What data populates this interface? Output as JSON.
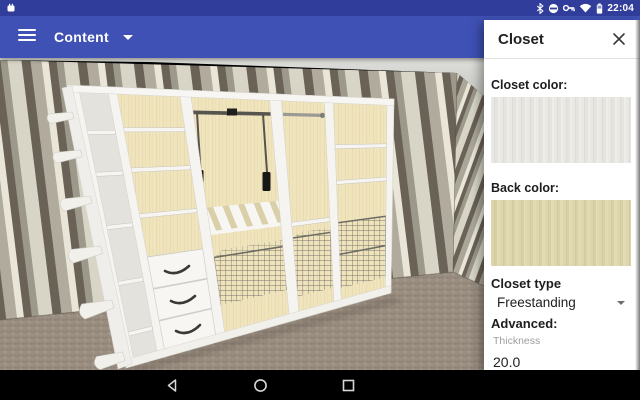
{
  "status_bar": {
    "time": "22:04",
    "left_icon": "app-notification-icon",
    "right_icons": [
      "bluetooth-icon",
      "do-not-disturb-icon",
      "key-icon",
      "wifi-icon",
      "battery-icon"
    ]
  },
  "toolbar": {
    "title": "Content",
    "menu_icon": "hamburger-menu-icon",
    "caret_icon": "dropdown-caret-icon"
  },
  "panel": {
    "title": "Closet",
    "close_icon": "close-icon",
    "closet_color_label": "Closet color:",
    "closet_color_swatch": "#e7e6e1",
    "back_color_label": "Back color:",
    "back_color_swatch": "#ddd5ab",
    "closet_type_label": "Closet type",
    "closet_type_value": "Freestanding",
    "advanced_label": "Advanced:",
    "thickness_label": "Thickness",
    "thickness_value": "20.0"
  },
  "navbar": {
    "icons": [
      "back-icon",
      "home-icon",
      "recents-icon"
    ]
  },
  "colors": {
    "status_bar": "#303d9b",
    "toolbar": "#3f51b5",
    "panel_bg": "#ffffff",
    "nav_bar": "#000000",
    "wall_stripe_dark": "#6a6257",
    "wall_stripe_olive": "#b0ab9c",
    "wall_stripe_cream": "#d8d5c6",
    "wall_stripe_white": "#e9e6d8",
    "ceiling": "#d8d8d4",
    "carpet": "#9a8e81",
    "closet_white": "#f3f2ed",
    "closet_back_beige": "#f0e4bd"
  }
}
